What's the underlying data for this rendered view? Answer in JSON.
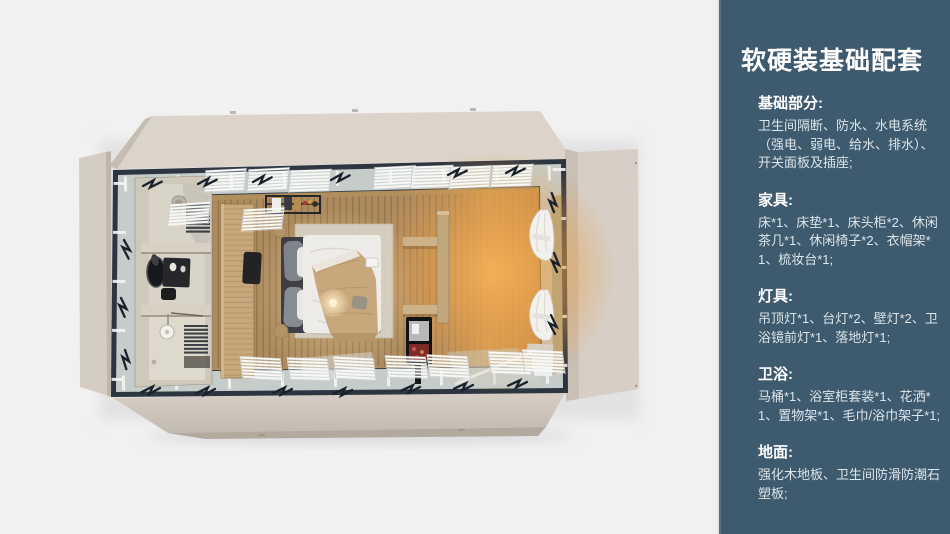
{
  "page": {
    "width": 950,
    "height": 534,
    "background": "#f1f1f2"
  },
  "sidebar": {
    "title": "软硬装基础配套",
    "background": "#3d5a6e",
    "edge_highlight": "#dfe6ea",
    "heading_color": "#ffffff",
    "body_color": "#dce5ea",
    "sections": [
      {
        "heading": "基础部分:",
        "body": "卫生间隔断、防水、水电系统（强电、弱电、给水、排水）、开关面板及插座;"
      },
      {
        "heading": "家具:",
        "body": "床*1、床垫*1、床头柜*2、休闲茶几*1、休闲椅子*2、衣帽架*1、梳妆台*1;"
      },
      {
        "heading": "灯具:",
        "body": "吊顶灯*1、台灯*2、壁灯*2、卫浴镜前灯*1、落地灯*1;"
      },
      {
        "heading": "卫浴:",
        "body": "马桶*1、浴室柜套装*1、花洒*1、置物架*1、毛巾/浴巾架子*1;"
      },
      {
        "heading": "地面:",
        "body": "强化木地板、卫生间防滑防潮石塑板;"
      }
    ]
  },
  "illustration": {
    "alt": "Top-down 3D render of a folding container guest room: bathroom with toilet, vanity and shower on the left, long wood dressing unit, double bed with tan throw on a pale rug, shelf partition with mini display cabinet, warm-lit lounge floor with tied white curtains, opened beige wall flaps on all four sides",
    "colors": {
      "shell_beige": "#d8d0c7",
      "frame_dark": "#2c3540",
      "window_band": "#c6ccc9",
      "floor_wood": "#ad8b5f",
      "warm_glow": "#f2a94e",
      "bathroom_wall": "#cfc9bc",
      "wood_unit": "#c7a87c",
      "duvet": "#edece8",
      "blanket": "#c9a77c",
      "curtain": "#f3f1ee"
    }
  }
}
